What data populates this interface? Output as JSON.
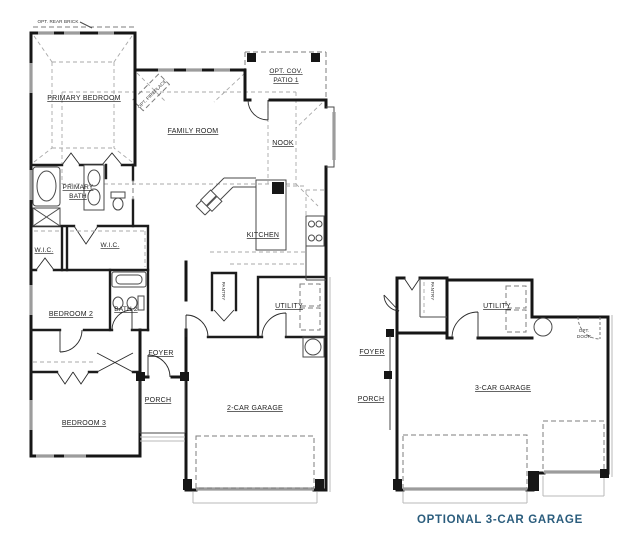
{
  "caption": {
    "label": "OPTIONAL 3-CAR GARAGE",
    "color": "#2b5d7d"
  },
  "main_plan": {
    "rooms": {
      "primary_bedroom": "PRIMARY BEDROOM",
      "family_room": "FAMILY ROOM",
      "nook": "NOOK",
      "kitchen": "KITCHEN",
      "primary_bath1": "PRIMARY",
      "primary_bath2": "BATH",
      "wic_left": "W.I.C.",
      "wic_right": "W.I.C.",
      "bedroom2": "BEDROOM 2",
      "bath2": "BATH 2",
      "bedroom3": "BEDROOM 3",
      "pantry": "PANTRY",
      "utility": "UTILITY",
      "foyer": "FOYER",
      "porch": "PORCH",
      "garage": "2-CAR GARAGE"
    },
    "annotations": {
      "opt_rear_brick": "OPT. REAR BRICK",
      "opt_fireplace": "OPT. FIREPLACE",
      "opt_cov_patio1": "OPT. COV.",
      "opt_cov_patio2": "PATIO 1"
    }
  },
  "alt_plan": {
    "rooms": {
      "pantry": "PANTRY",
      "utility": "UTILITY",
      "foyer": "FOYER",
      "porch": "PORCH",
      "garage": "3-CAR GARAGE"
    },
    "annotations": {
      "opt_door1": "OPT.",
      "opt_door2": "DOOR"
    }
  }
}
